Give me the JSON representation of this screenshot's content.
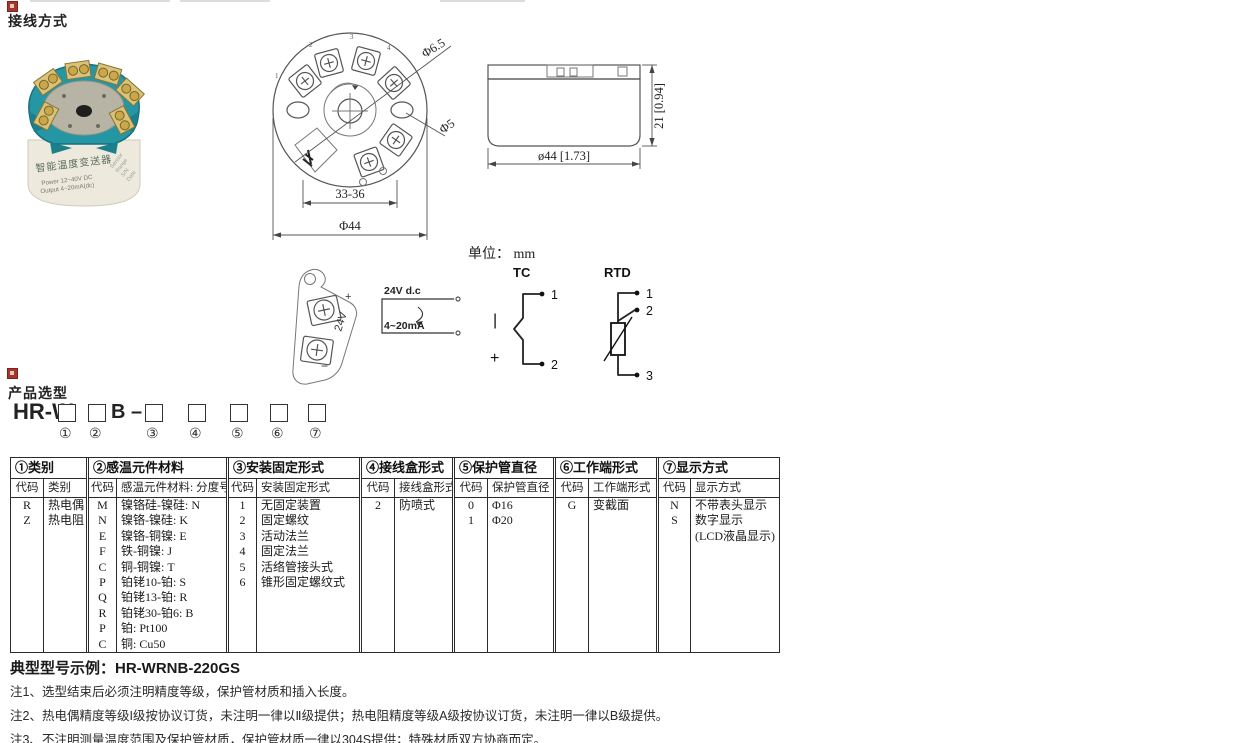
{
  "page": {
    "section1_title": "接线方式",
    "section2_title": "产品选型",
    "unit_note": "单位： mm",
    "example_label": "典型型号示例：",
    "example_value": "HR-WRNB-220GS",
    "notes": [
      "注1、选型结束后必须注明精度等级，保护管材质和插入长度。",
      "注2、热电偶精度等级I级按协议订货，未注明一律以Ⅱ级提供；热电阻精度等级A级按协议订货，未注明一律以B级提供。",
      "注3、不注明测量温度范围及保护管材质，保护管材质一律以304S提供；特殊材质双方协商而定。"
    ]
  },
  "photo": {
    "label_title": "智能温度变送器",
    "label_line1": "Power  12~40V DC",
    "label_line2": "Output  4~20mA(dc)",
    "side1": "Sensor",
    "side2": "Range",
    "side3": "S/N",
    "side4": "Date"
  },
  "top_view": {
    "t1": "1",
    "t2": "2",
    "t3": "3",
    "t4": "4",
    "dim_hole_big": "Φ6.5",
    "dim_hole_small": "Φ5",
    "dim_inner": "33-36",
    "dim_outer": "Φ44"
  },
  "side_view": {
    "dim_height": "21 [0.94]",
    "dim_width": "ø44 [1.73]"
  },
  "clip": {
    "plus": "+",
    "label": "24V",
    "minus": "−"
  },
  "loop": {
    "top_label": "24V d.c",
    "bottom_label": "4~20mA"
  },
  "tc": {
    "title": "TC",
    "t1": "1",
    "t2": "2",
    "neg": "|",
    "pos": "+"
  },
  "rtd": {
    "title": "RTD",
    "t1": "1",
    "t2": "2",
    "t3": "3"
  },
  "model": {
    "prefix": "HR-W",
    "mid": "B –",
    "d1": "①",
    "d2": "②",
    "d3": "③",
    "d4": "④",
    "d5": "⑤",
    "d6": "⑥",
    "d7": "⑦"
  },
  "table": {
    "groups": [
      {
        "header": "①类别",
        "sub_code": "代码",
        "sub_label": "类别",
        "codes": [
          "R",
          "Z"
        ],
        "labels": [
          "热电偶",
          "热电阻"
        ]
      },
      {
        "header": "②感温元件材料",
        "sub_code": "代码",
        "sub_label": "感温元件材料: 分度号",
        "codes": [
          "M",
          "N",
          "E",
          "F",
          "C",
          "P",
          "Q",
          "R",
          "P",
          "C"
        ],
        "labels": [
          "镍铬硅-镍硅: N",
          "镍铬-镍硅: K",
          "镍铬-铜镍: E",
          "铁-铜镍: J",
          "铜-铜镍: T",
          "铂铑10-铂: S",
          "铂铑13-铂: R",
          "铂铑30-铂6: B",
          "铂: Pt100",
          "铜: Cu50"
        ]
      },
      {
        "header": "③安装固定形式",
        "sub_code": "代码",
        "sub_label": "安装固定形式",
        "codes": [
          "1",
          "2",
          "3",
          "4",
          "5",
          "6"
        ],
        "labels": [
          "无固定装置",
          "固定螺纹",
          "活动法兰",
          "固定法兰",
          "活络管接头式",
          "锥形固定螺纹式"
        ]
      },
      {
        "header": "④接线盒形式",
        "sub_code": "代码",
        "sub_label": "接线盒形式",
        "codes": [
          "2"
        ],
        "labels": [
          "防喷式"
        ]
      },
      {
        "header": "⑤保护管直径",
        "sub_code": "代码",
        "sub_label": "保护管直径",
        "codes": [
          "0",
          "1"
        ],
        "labels": [
          "Φ16",
          "Φ20"
        ]
      },
      {
        "header": "⑥工作端形式",
        "sub_code": "代码",
        "sub_label": "工作端形式",
        "codes": [
          "G"
        ],
        "labels": [
          "变截面"
        ]
      },
      {
        "header": "⑦显示方式",
        "sub_code": "代码",
        "sub_label": "显示方式",
        "codes": [
          "N",
          "S",
          ""
        ],
        "labels": [
          "不带表头显示",
          "数字显示",
          "(LCD液晶显示)"
        ]
      }
    ]
  }
}
